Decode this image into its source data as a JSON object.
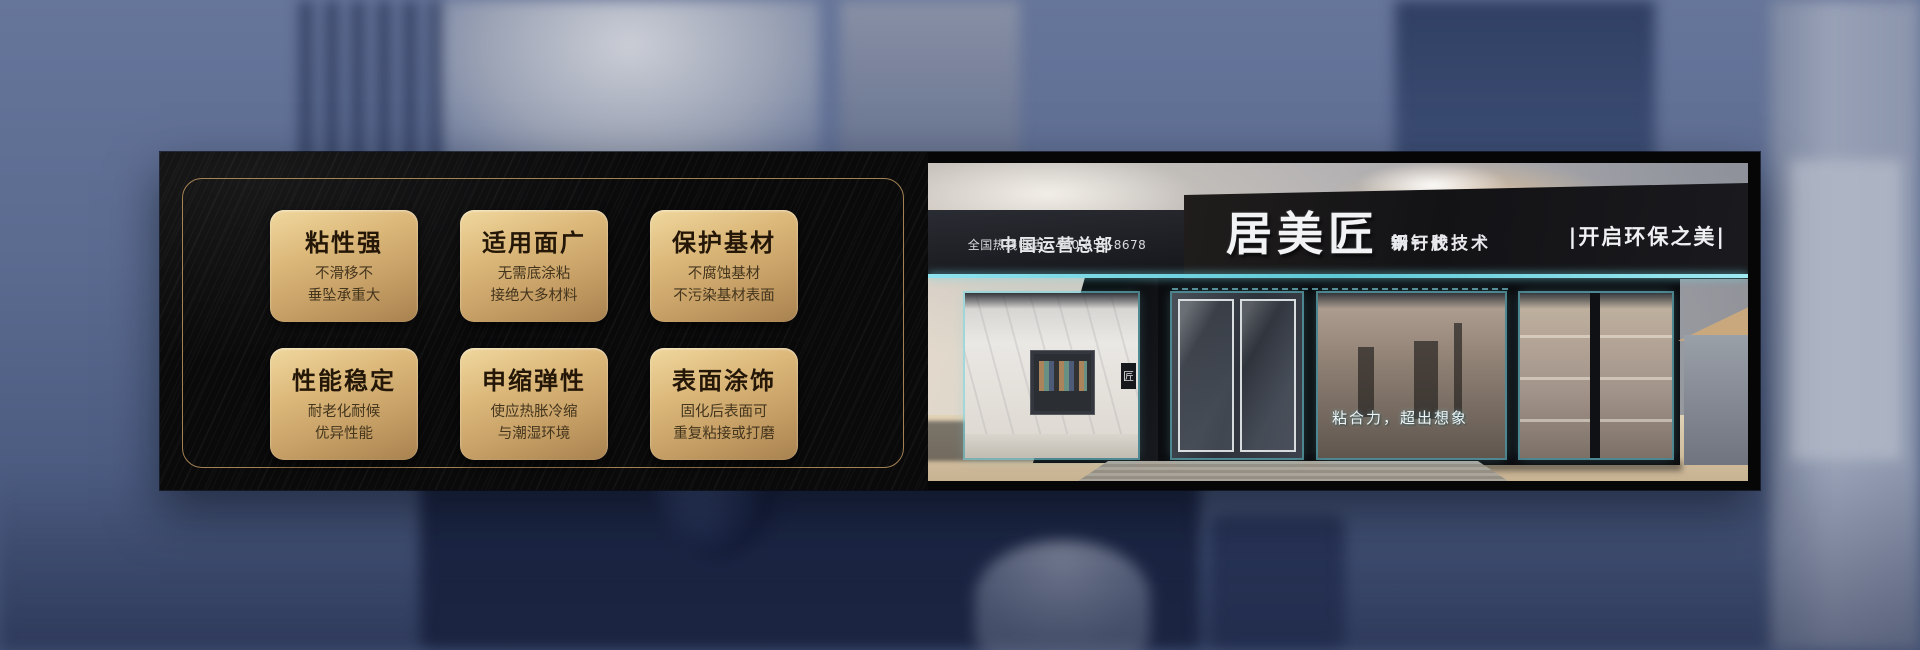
{
  "features": [
    {
      "title": "粘性强",
      "line1": "不滑移不",
      "line2": "垂坠承重大"
    },
    {
      "title": "适用面广",
      "line1": "无需底涂粘",
      "line2": "接绝大多材料"
    },
    {
      "title": "保护基材",
      "line1": "不腐蚀基材",
      "line2": "不污染基材表面"
    },
    {
      "title": "性能稳定",
      "line1": "耐老化耐候",
      "line2": "优异性能"
    },
    {
      "title": "申缩弹性",
      "line1": "使应热胀冷缩",
      "line2": "与潮湿环境"
    },
    {
      "title": "表面涂饰",
      "line1": "固化后表面可",
      "line2": "重复粘接或打磨"
    }
  ],
  "storefront": {
    "hq_label": "中国运营总部",
    "hotline": "全国热线电话：400-656-8678",
    "brand": "居美匠",
    "product_line1": "钢钉胶",
    "product_line2": "新一代技术",
    "eco_slogan": "|开启环保之美|",
    "window_slogan": "粘合力，超出想象",
    "plaque_glyph": "匠"
  },
  "colors": {
    "card_gold_light": "#f0d89e",
    "card_gold_dark": "#a8824f",
    "card_text": "#241708",
    "panel_black": "#0a0a0b",
    "frame_gold": "#be965f",
    "neon_cyan": "#7fdce8",
    "backdrop_blue": "#5b6b90",
    "sand": "#d3bf9f"
  }
}
